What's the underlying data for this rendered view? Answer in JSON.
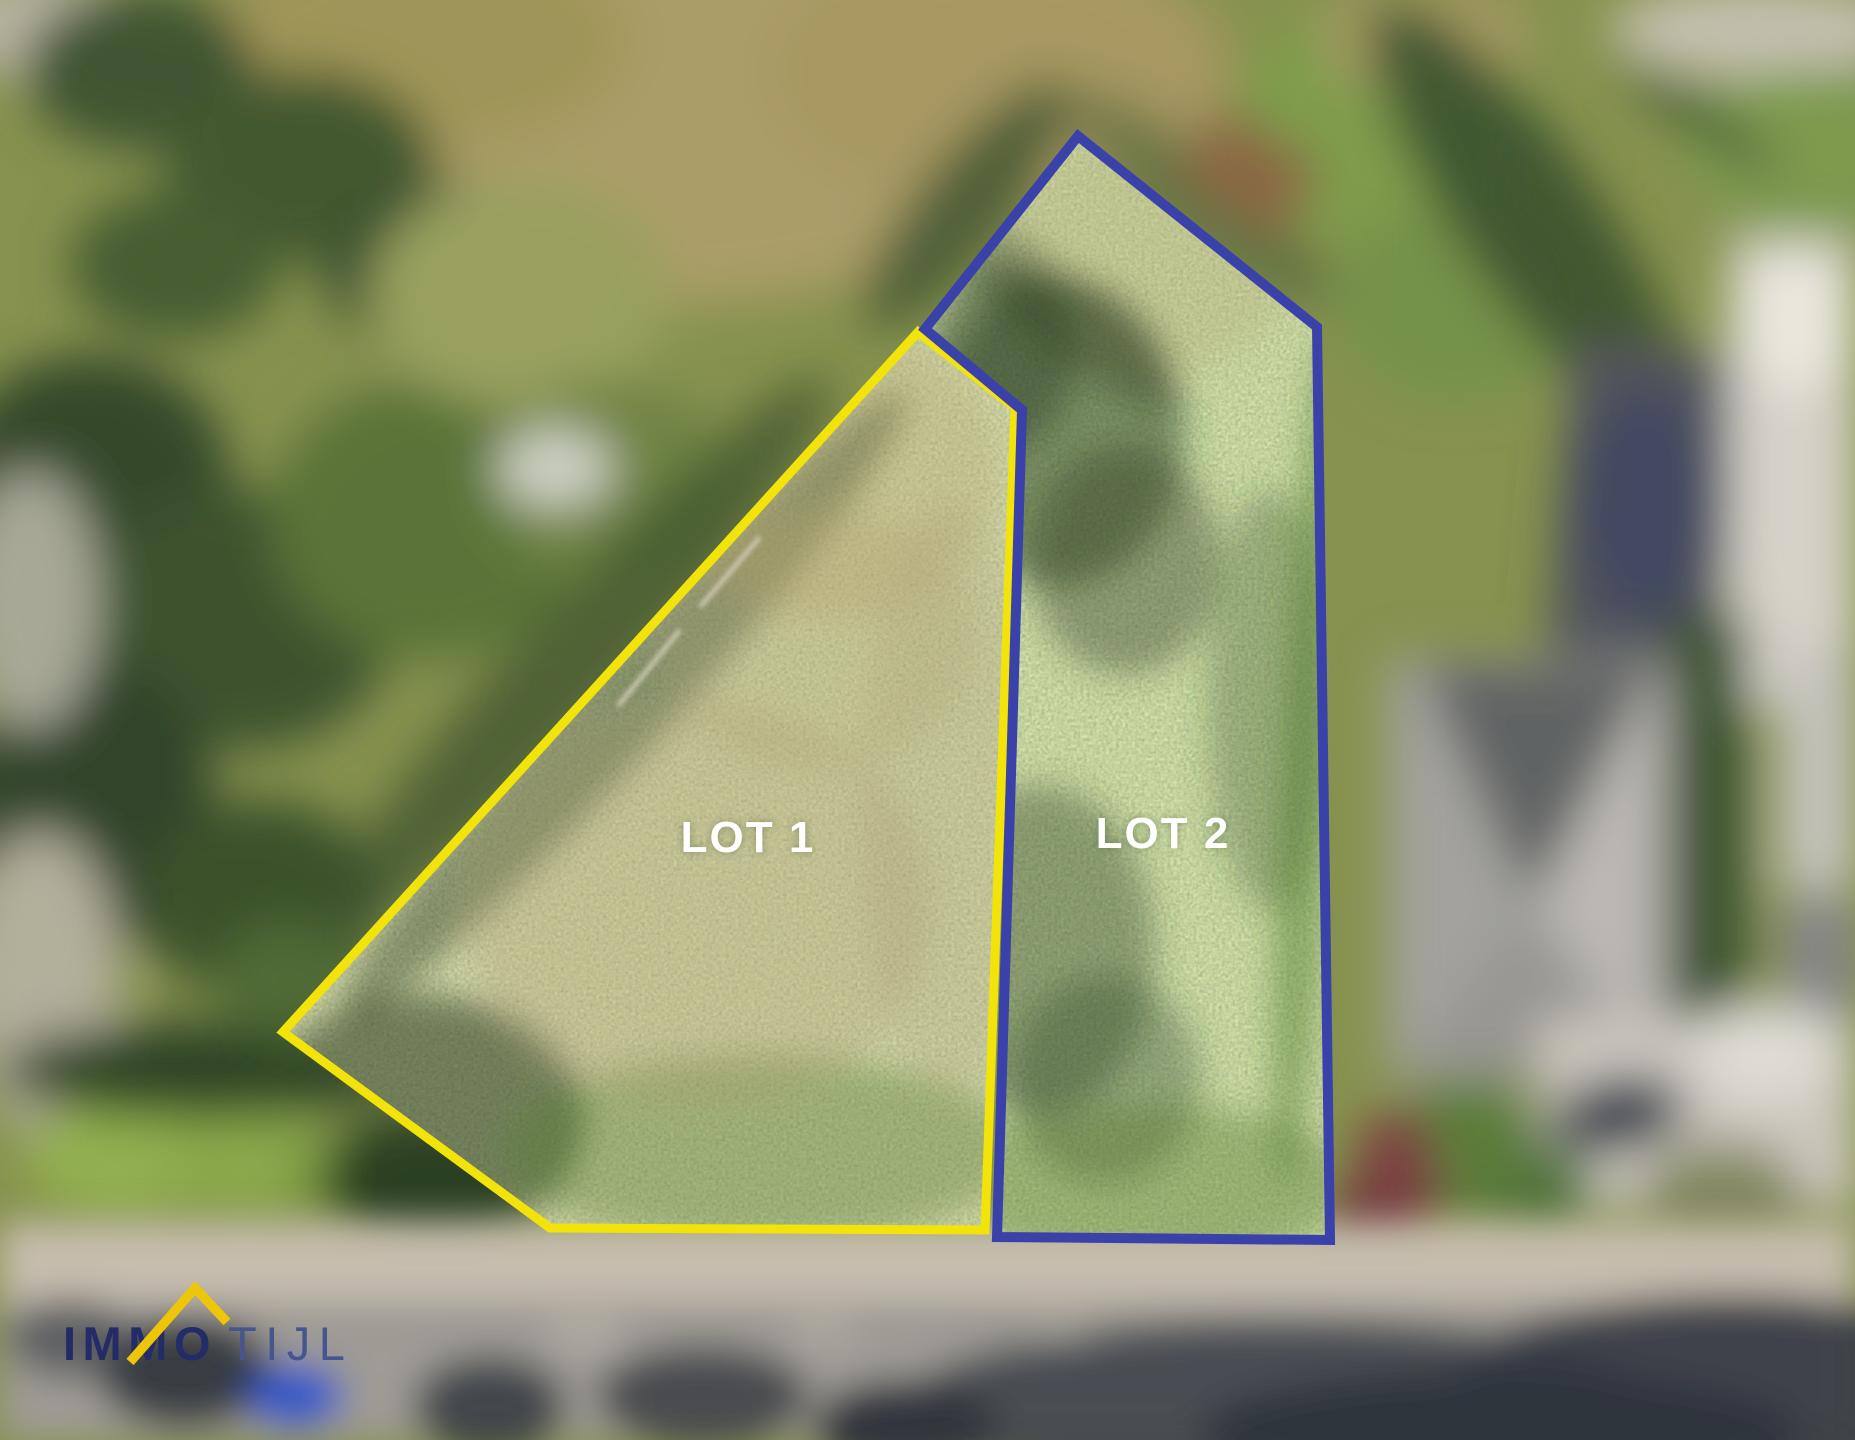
{
  "image": {
    "kind": "aerial-drone-photo-with-lot-overlay",
    "width_px": 1855,
    "height_px": 1440
  },
  "lots": {
    "lot1": {
      "label": "LOT 1",
      "outline_color": "#F2E30B"
    },
    "lot2": {
      "label": "LOT 2",
      "outline_color": "#3A41A8"
    }
  },
  "labels": {
    "text_color": "#FFFFFF"
  },
  "logo": {
    "bold_text": "IMMO",
    "light_text": "TIJL",
    "bold_color": "#232C68",
    "light_color": "#47558E",
    "roof_color": "#EDC60A"
  }
}
